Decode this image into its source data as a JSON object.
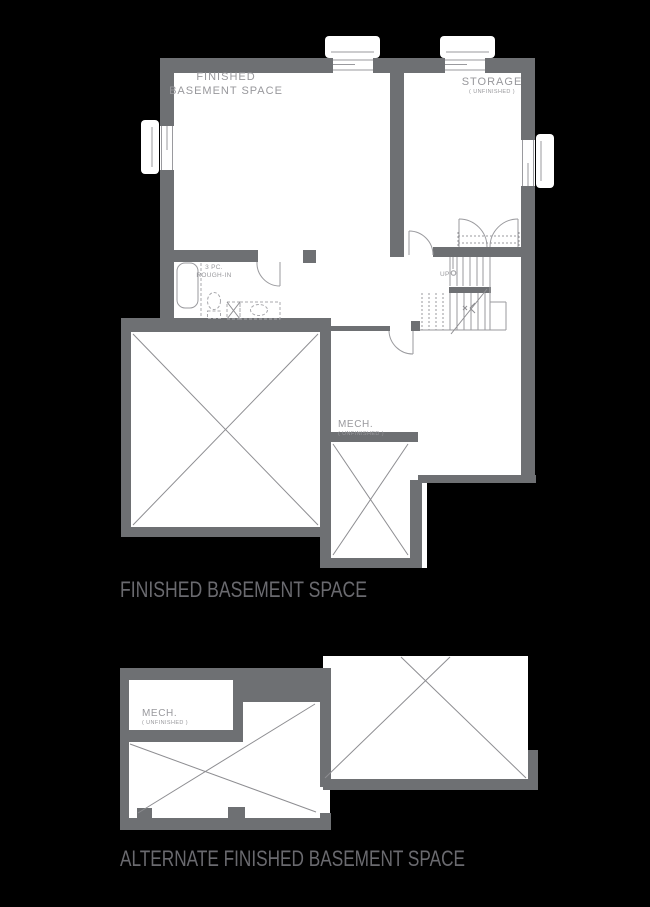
{
  "document_type": "basement floor plan sheet",
  "colors": {
    "background": "#000000",
    "floor": "#ffffff",
    "wall": "#6e7073",
    "line": "#9a9a9e",
    "xline": "#8d8d91",
    "fixture": "#a8a8ac",
    "label": "#98989c",
    "caption": "#6a6a6f"
  },
  "main_plan": {
    "labels": {
      "finished_line1": "FINISHED",
      "finished_line2": "BASEMENT SPACE",
      "storage": "STORAGE",
      "storage_sub": "( UNFINISHED )",
      "mech": "MECH.",
      "mech_sub": "( UNFINISHED )",
      "roughin_line1": "3 PC.",
      "roughin_line2": "ROUGH-IN",
      "up": "UP"
    },
    "caption": "FINISHED BASEMENT SPACE"
  },
  "alt_plan": {
    "labels": {
      "mech": "MECH.",
      "mech_sub": "( UNFINISHED )"
    },
    "caption": "ALTERNATE FINISHED BASEMENT SPACE"
  }
}
